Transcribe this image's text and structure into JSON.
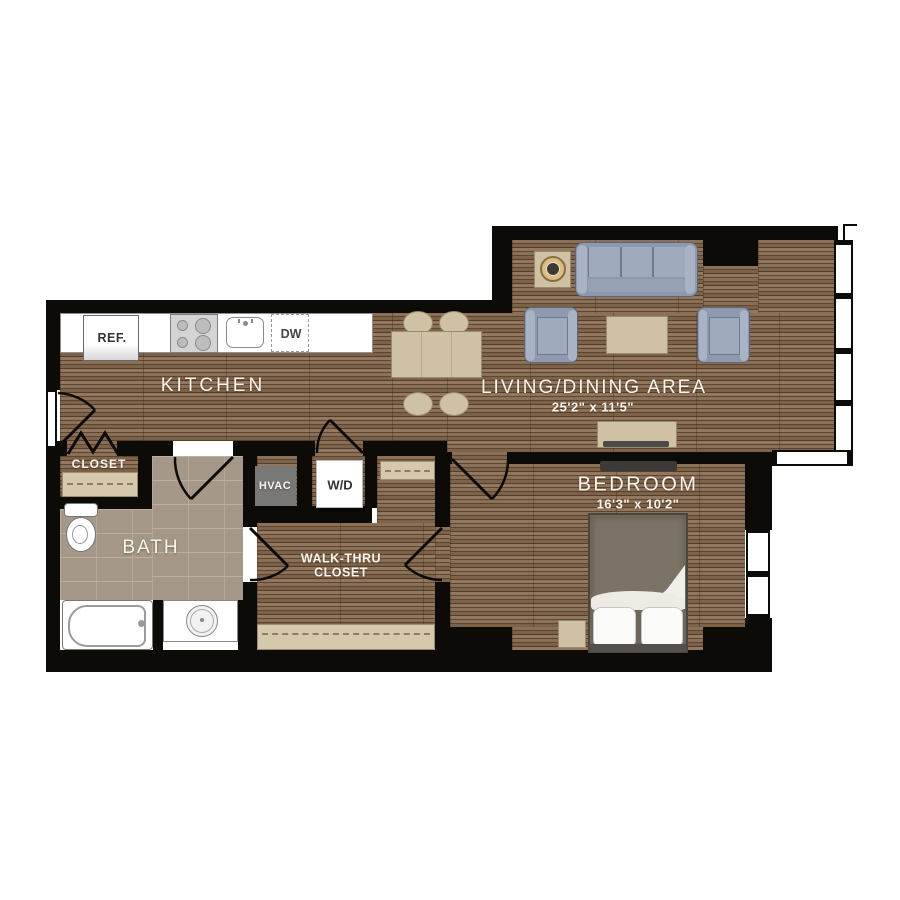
{
  "plan": {
    "rooms": {
      "kitchen": {
        "label": "KITCHEN"
      },
      "living_dining": {
        "label": "LIVING/DINING AREA",
        "dimensions": "25'2\" x 11'5\""
      },
      "bedroom": {
        "label": "BEDROOM",
        "dimensions": "16'3\" x 10'2\""
      },
      "bath": {
        "label": "BATH"
      },
      "entry_closet": {
        "label": "CLOSET"
      },
      "walkthru_closet": {
        "label_line1": "WALK-THRU",
        "label_line2": "CLOSET"
      }
    },
    "fixtures": {
      "hvac": {
        "label": "HVAC"
      },
      "washer_dryer": {
        "label": "W/D"
      },
      "refrigerator": {
        "label": "REF."
      },
      "dishwasher": {
        "label": "DW"
      }
    },
    "colors": {
      "wall": "#0d0b08",
      "wood_floor": "#7a5f47",
      "bath_tile": "#a59889",
      "shelf": "#d5c8ac",
      "upholstery": "#8f99ad",
      "wood_furniture": "#cec1a4",
      "label_text": "#f8f4ee"
    }
  }
}
